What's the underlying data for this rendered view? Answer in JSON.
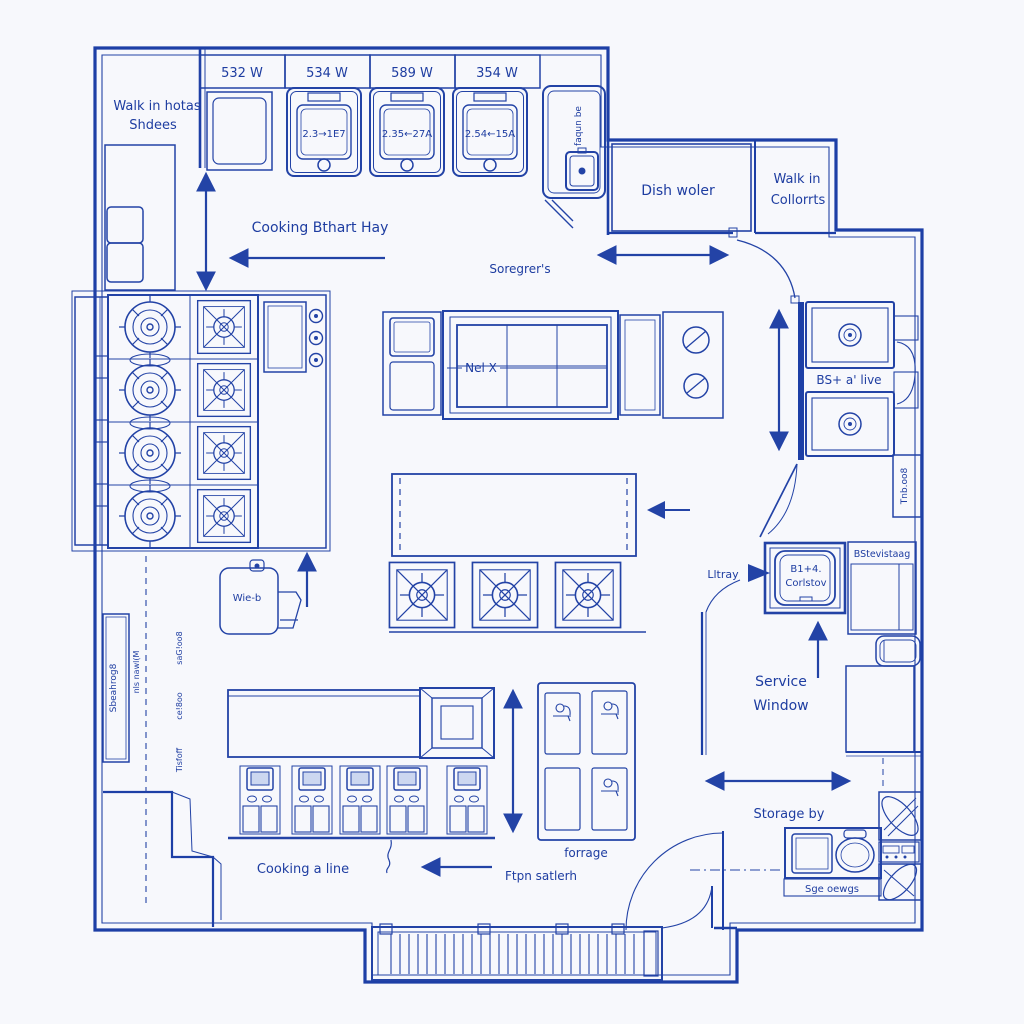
{
  "colors": {
    "line": "#2343a6",
    "wall": "#1d3fa6",
    "text": "#1e3da1",
    "paper": "#fdfdff",
    "background": "#f7f8fc",
    "screen_fill": "#ccd7f0"
  },
  "labels": {
    "dims": {
      "d1": "532 W",
      "d2": "534 W",
      "d3": "589 W",
      "d4": "354 W"
    },
    "ovens": {
      "o1": "2.3→1E7",
      "o2": "2.35←27A",
      "o3": "2.54←15A"
    },
    "walkin_shelves": {
      "l1": "Walk in hotas",
      "l2": "Shdees"
    },
    "alcove_vtext": "faqun be",
    "dish_room": "Dish woler",
    "walkin_cold": {
      "l1": "Walk in",
      "l2": "Collorrts"
    },
    "hood": "Cooking Bthart Hay",
    "aisle": "Soregrer's",
    "table": "Nel X",
    "sink_right": "BS+ a' live",
    "right_vtext": "Tnb.oo8",
    "pantry_vtext": "Sbeahrog8",
    "wall_vtexts": {
      "t1": "saG!oo8",
      "t2": "ce!8oo",
      "t3": "Tisfoff",
      "dash": "nls nawl(M"
    },
    "machine": "Wie-b",
    "litray": "Lltray",
    "prep_sink": {
      "l1": "B1+4.",
      "l2": "Corlstov"
    },
    "shelf_right": "BStevistaag",
    "service_window": {
      "l1": "Service",
      "l2": "Window"
    },
    "cook_line": "Cooking a line",
    "prep_area": "Ftpn satlerh",
    "storage_unit": "forrage",
    "storage_area": "Storage by",
    "wash_sink": "Sge oewgs"
  }
}
